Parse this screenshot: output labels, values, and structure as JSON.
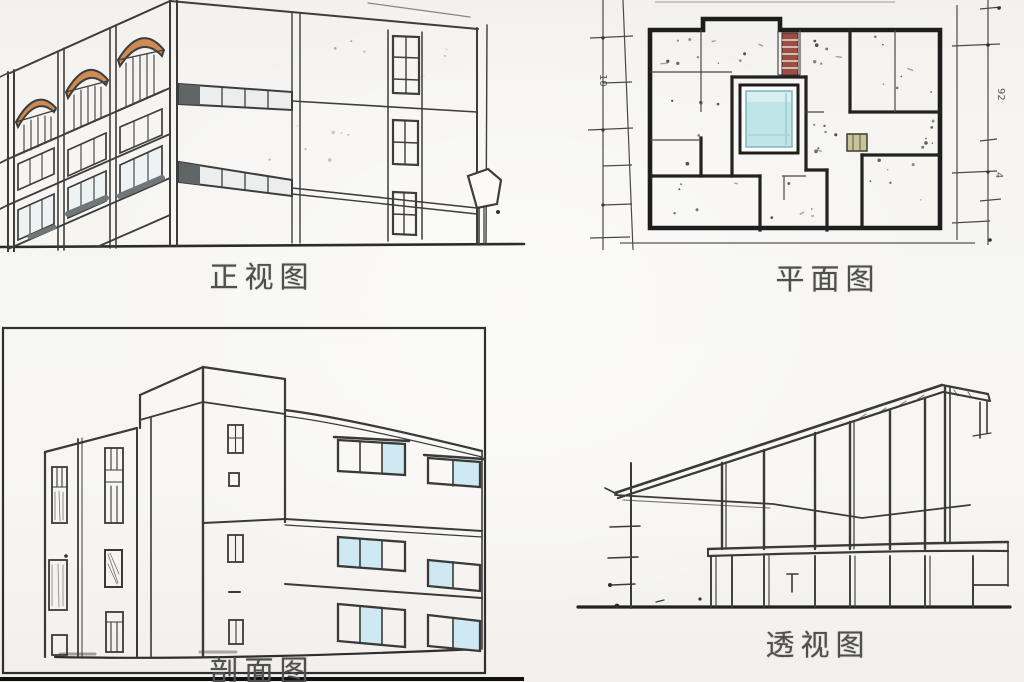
{
  "page": {
    "background": "#f6f5f2"
  },
  "panels": {
    "front_view": {
      "label": "正视图"
    },
    "plan_view": {
      "label": "平面图"
    },
    "section_view": {
      "label": "剖面图"
    },
    "perspective_view": {
      "label": "透视图"
    }
  },
  "plan_dimensions": {
    "left": "10",
    "right_upper": "92",
    "right_lower": "4"
  },
  "colors": {
    "sketch_line": "#3d3d3d",
    "wall_black": "#1d1d1d",
    "arch_orange": "#cd8a52",
    "pool_cyan": "#bfe5e8",
    "stair_red": "#9a4f42",
    "window_blue": "#cfe9f3",
    "fixture_olive": "#c9c39a",
    "label_text": "#4f4f4f"
  }
}
